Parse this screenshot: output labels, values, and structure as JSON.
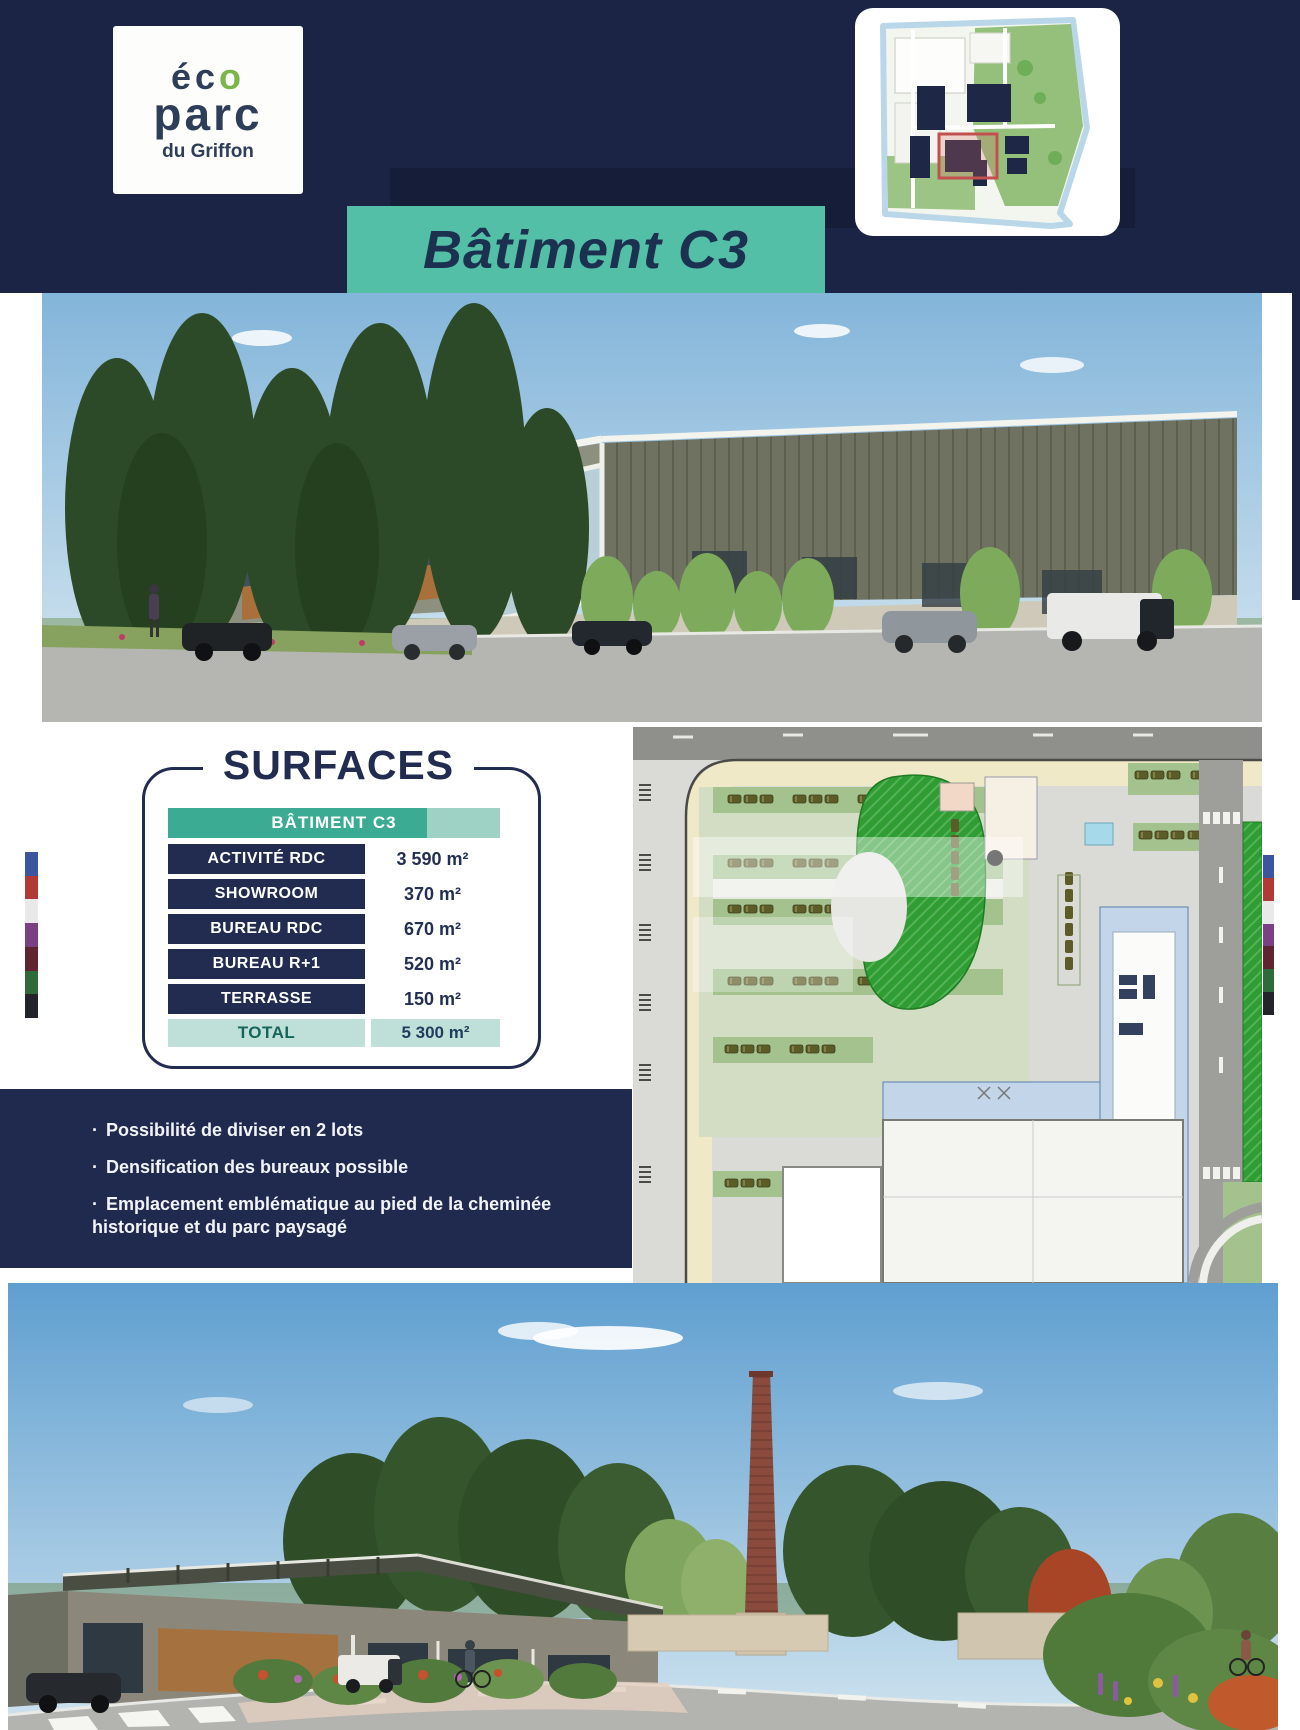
{
  "header": {
    "logo": {
      "eco_prefix": "éc",
      "eco_o": "o",
      "parc": "parc",
      "subtitle": "du Griffon"
    },
    "banner": {
      "label": "Bâtiment C3"
    }
  },
  "surfaces": {
    "title": "SURFACES",
    "table": {
      "header": "BÂTIMENT C3",
      "rows": [
        {
          "label": "ACTIVITÉ RDC",
          "value": "3 590 m²"
        },
        {
          "label": "SHOWROOM",
          "value": "370 m²"
        },
        {
          "label": "BUREAU RDC",
          "value": "670 m²"
        },
        {
          "label": "BUREAU R+1",
          "value": "520 m²"
        },
        {
          "label": "TERRASSE",
          "value": "150 m²"
        }
      ],
      "total": {
        "label": "TOTAL",
        "value": "5 300 m²"
      }
    }
  },
  "highlights": {
    "bullet": "·",
    "items": [
      "Possibilité de diviser en 2 lots",
      "Densification des bureaux possible",
      "Emplacement emblématique au pied de la cheminée historique et du parc paysagé"
    ]
  },
  "colors": {
    "navy": "#1b2444",
    "teal_banner": "#52bfa6",
    "teal_header": "#3cab93",
    "mint_total": "#bfe0d8",
    "row_navy": "#222b50"
  }
}
